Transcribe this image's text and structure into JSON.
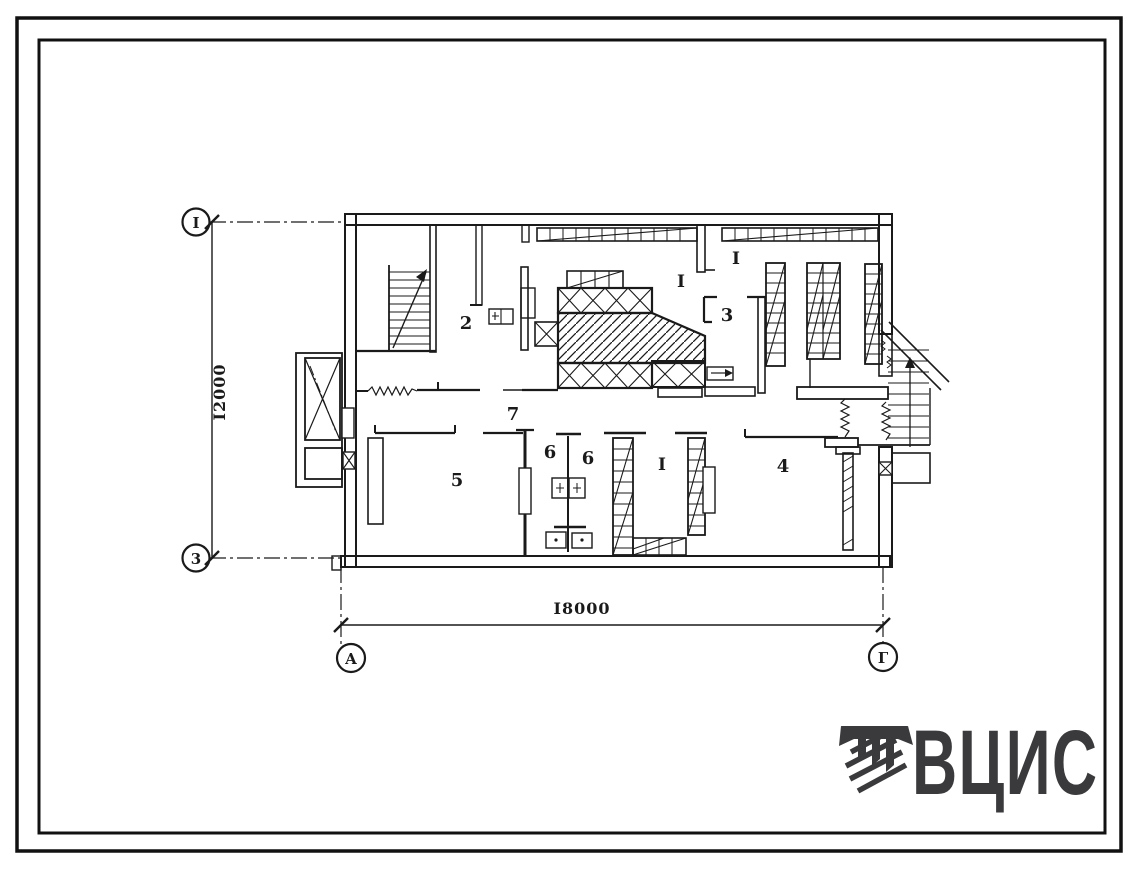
{
  "meta": {
    "sheet_type": "floor plan drawing"
  },
  "colors": {
    "ink": "#1a1a1a",
    "logo": "#3a3a3c",
    "paper": "#ffffff"
  },
  "axes": {
    "row_top": "I",
    "row_bottom": "3",
    "col_left": "А",
    "col_right": "Г"
  },
  "dimensions": {
    "vertical": "I2000",
    "horizontal": "I8000"
  },
  "rooms": {
    "r2": "2",
    "r3": "3",
    "r4": "4",
    "r5": "5",
    "r6a": "6",
    "r6b": "6",
    "r7": "7",
    "i_upper_left": "I",
    "i_upper_right": "I",
    "i_lower": "I"
  },
  "logo": {
    "text": "ВЦИС"
  }
}
